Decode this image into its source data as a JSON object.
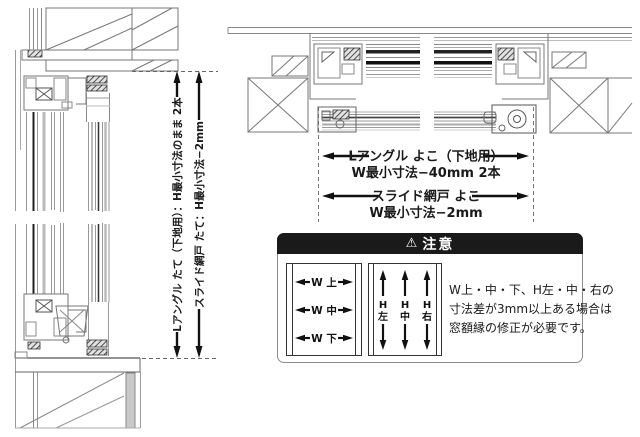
{
  "colors": {
    "line_light": "#9a9a9a",
    "line_mid": "#666666",
    "line_dark": "#1a1a1a",
    "caution_header_bg": "#1a1a1a",
    "caution_header_text": "#ffffff",
    "background": "#ffffff"
  },
  "vertical_section": {
    "dim_l_angle": "Lアングル たて（下地用）：H最小寸法のまま 2本",
    "dim_slide_screen": "スライド網戸 たて：H最小寸法−2mm"
  },
  "horizontal_section": {
    "dim_l_angle_line1": "Lアングル よこ（下地用）",
    "dim_l_angle_line2": "W最小寸法−40mm 2本",
    "dim_slide_screen_line1": "スライド網戸 よこ",
    "dim_slide_screen_line2": "W最小寸法−2mm"
  },
  "caution": {
    "icon": "⚠",
    "title": "注意",
    "w_labels": [
      "W 上",
      "W 中",
      "W 下"
    ],
    "h_labels": [
      [
        "H",
        "左"
      ],
      [
        "H",
        "中"
      ],
      [
        "H",
        "右"
      ]
    ],
    "note_lines": [
      "W上・中・下、H左・中・右の",
      "寸法差が3mm以上ある場合は",
      "窓額縁の修正が必要です。"
    ]
  }
}
